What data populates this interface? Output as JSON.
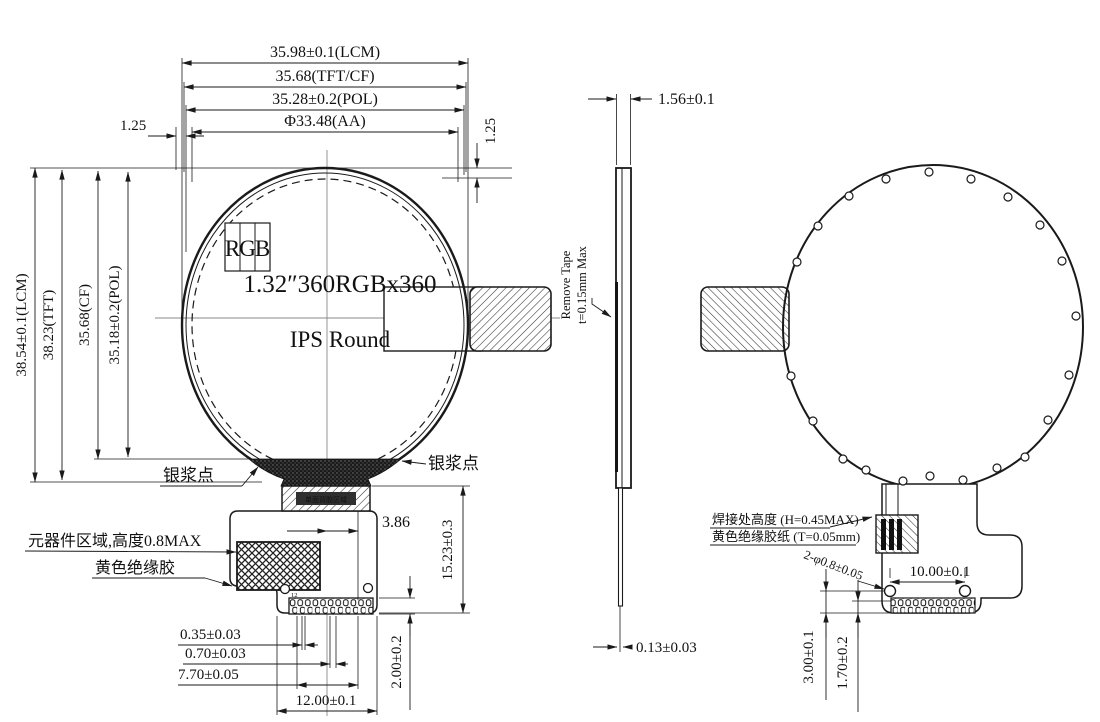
{
  "meta": {
    "drawing_type": "LCD module outline drawing",
    "colors": {
      "line": "#1a1a1a",
      "centerline": "#8a8a8a",
      "background": "#ffffff"
    }
  },
  "front": {
    "top_dims": [
      "35.98±0.1(LCM)",
      "35.68(TFT/CF)",
      "35.28±0.2(POL)",
      "Φ33.48(AA)"
    ],
    "left_dims": [
      "38.54±0.1(LCM)",
      "38.23(TFT)",
      "35.68(CF)",
      "35.18±0.2(POL)"
    ],
    "dim_left_125": "1.25",
    "dim_right_125": "1.25",
    "rgb": [
      "R",
      "G",
      "B"
    ],
    "panel_line1": "1.32″360RGBx360",
    "panel_line2": "IPS Round",
    "silver_left": "银浆点",
    "silver_right": "银浆点",
    "adhesive_bar": "单面背胶区域",
    "component_area": "元器件区域,高度0.8MAX",
    "yellow_glue": "黄色绝缘胶",
    "dim_386": "3.86",
    "dim_1523": "15.23±0.3",
    "hole_label": "12",
    "dim_035": "0.35±0.03",
    "dim_070": "0.70±0.03",
    "dim_770": "7.70±0.05",
    "dim_1200": "12.00±0.1",
    "dim_200": "2.00±0.2"
  },
  "side": {
    "dim_156": "1.56±0.1",
    "tape1": "Remove Tape",
    "tape2": "t=0.15mm Max",
    "dim_013": "0.13±0.03"
  },
  "back": {
    "solder": "焊接处高度 (H=0.45MAX)",
    "tape": "黄色绝缘胶纸 (T=0.05mm)",
    "holes": "2-φ0.8±0.05",
    "dim_1000": "10.00±0.1",
    "pin1": "1",
    "pin12": "12",
    "dim_300": "3.00±0.1",
    "dim_170": "1.70±0.2"
  }
}
